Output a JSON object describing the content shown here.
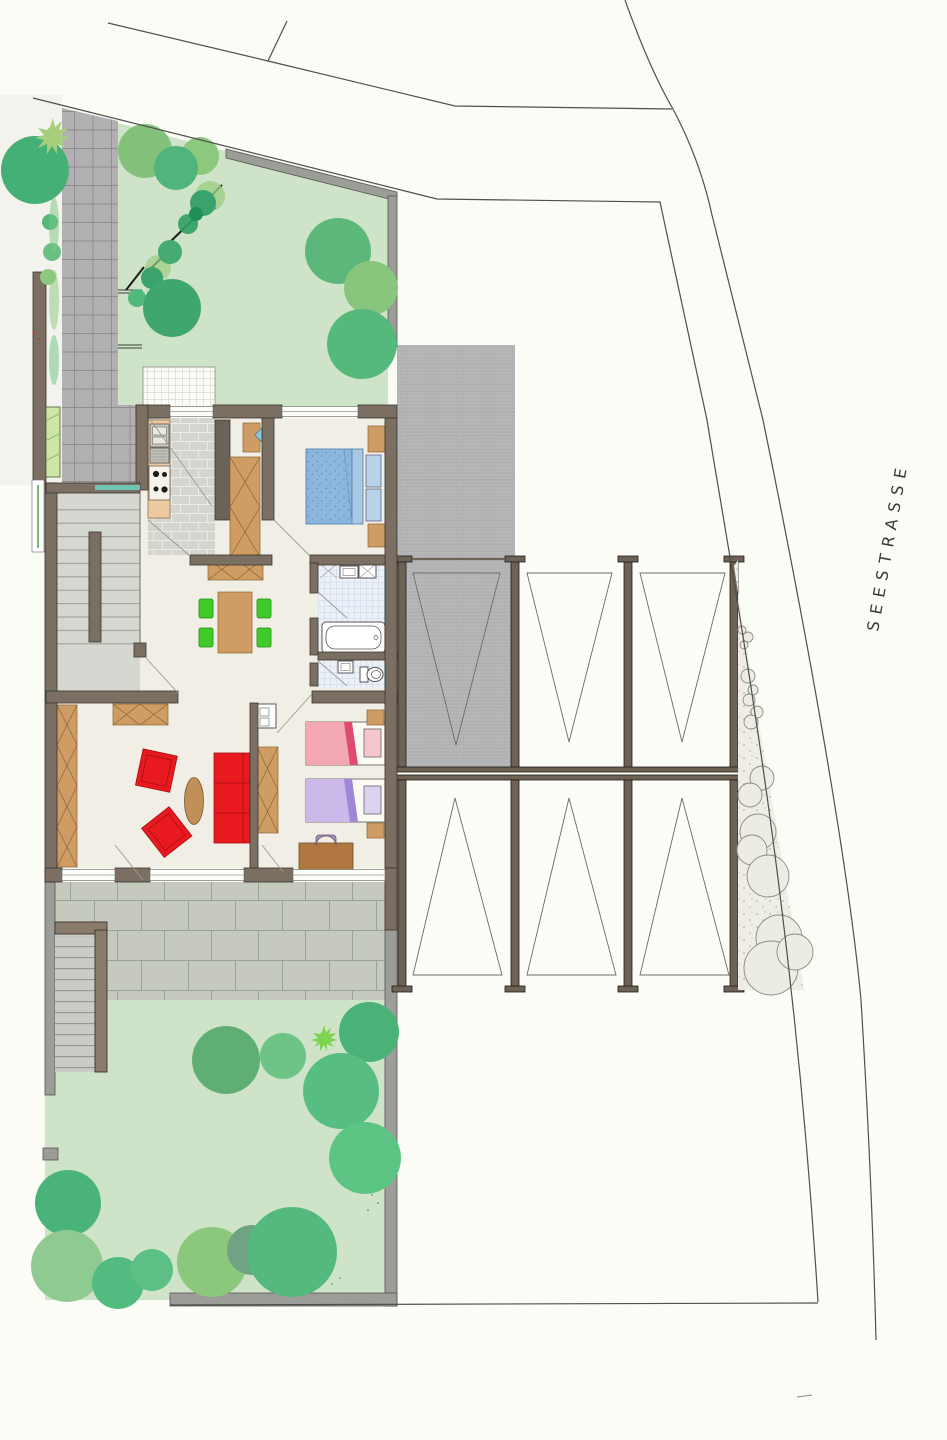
{
  "street_label": "SEESTRASSE",
  "plan": {
    "type": "architectural site and floor plan",
    "rooms": [
      "entry-stair-hall",
      "kitchen",
      "dining-living-area",
      "bedroom",
      "bathroom",
      "wc",
      "children-room"
    ],
    "outdoor": [
      "front-garden",
      "paved-entry-path",
      "driveway",
      "terrace",
      "rear-garden",
      "garden-stairs"
    ],
    "parking": {
      "rows": 2,
      "spaces_per_row": 3,
      "total_spaces": 6
    }
  },
  "palette": {
    "wall": "#7b6f63",
    "wallGray": "#9c9c98",
    "parkingWall": "#6e6156",
    "floor": "#f1eee5",
    "lawn": "#cfe3c8",
    "path": "#b2b0b2",
    "terrace": "#c5c9be",
    "driveway": "#b7b7b9",
    "wood": "#cf9c63",
    "woodLight": "#ecc9a0",
    "red": "#e8191f",
    "chairGreen": "#3fcb28",
    "bedBlue": "#8cb6dc",
    "bedPink": "#f2a7b2",
    "bedPurple": "#cbb9ea",
    "glassTeal": "#6fc4b4",
    "boundaryLine": "#4f4f4b",
    "treeGreen": "#5cb87a"
  }
}
